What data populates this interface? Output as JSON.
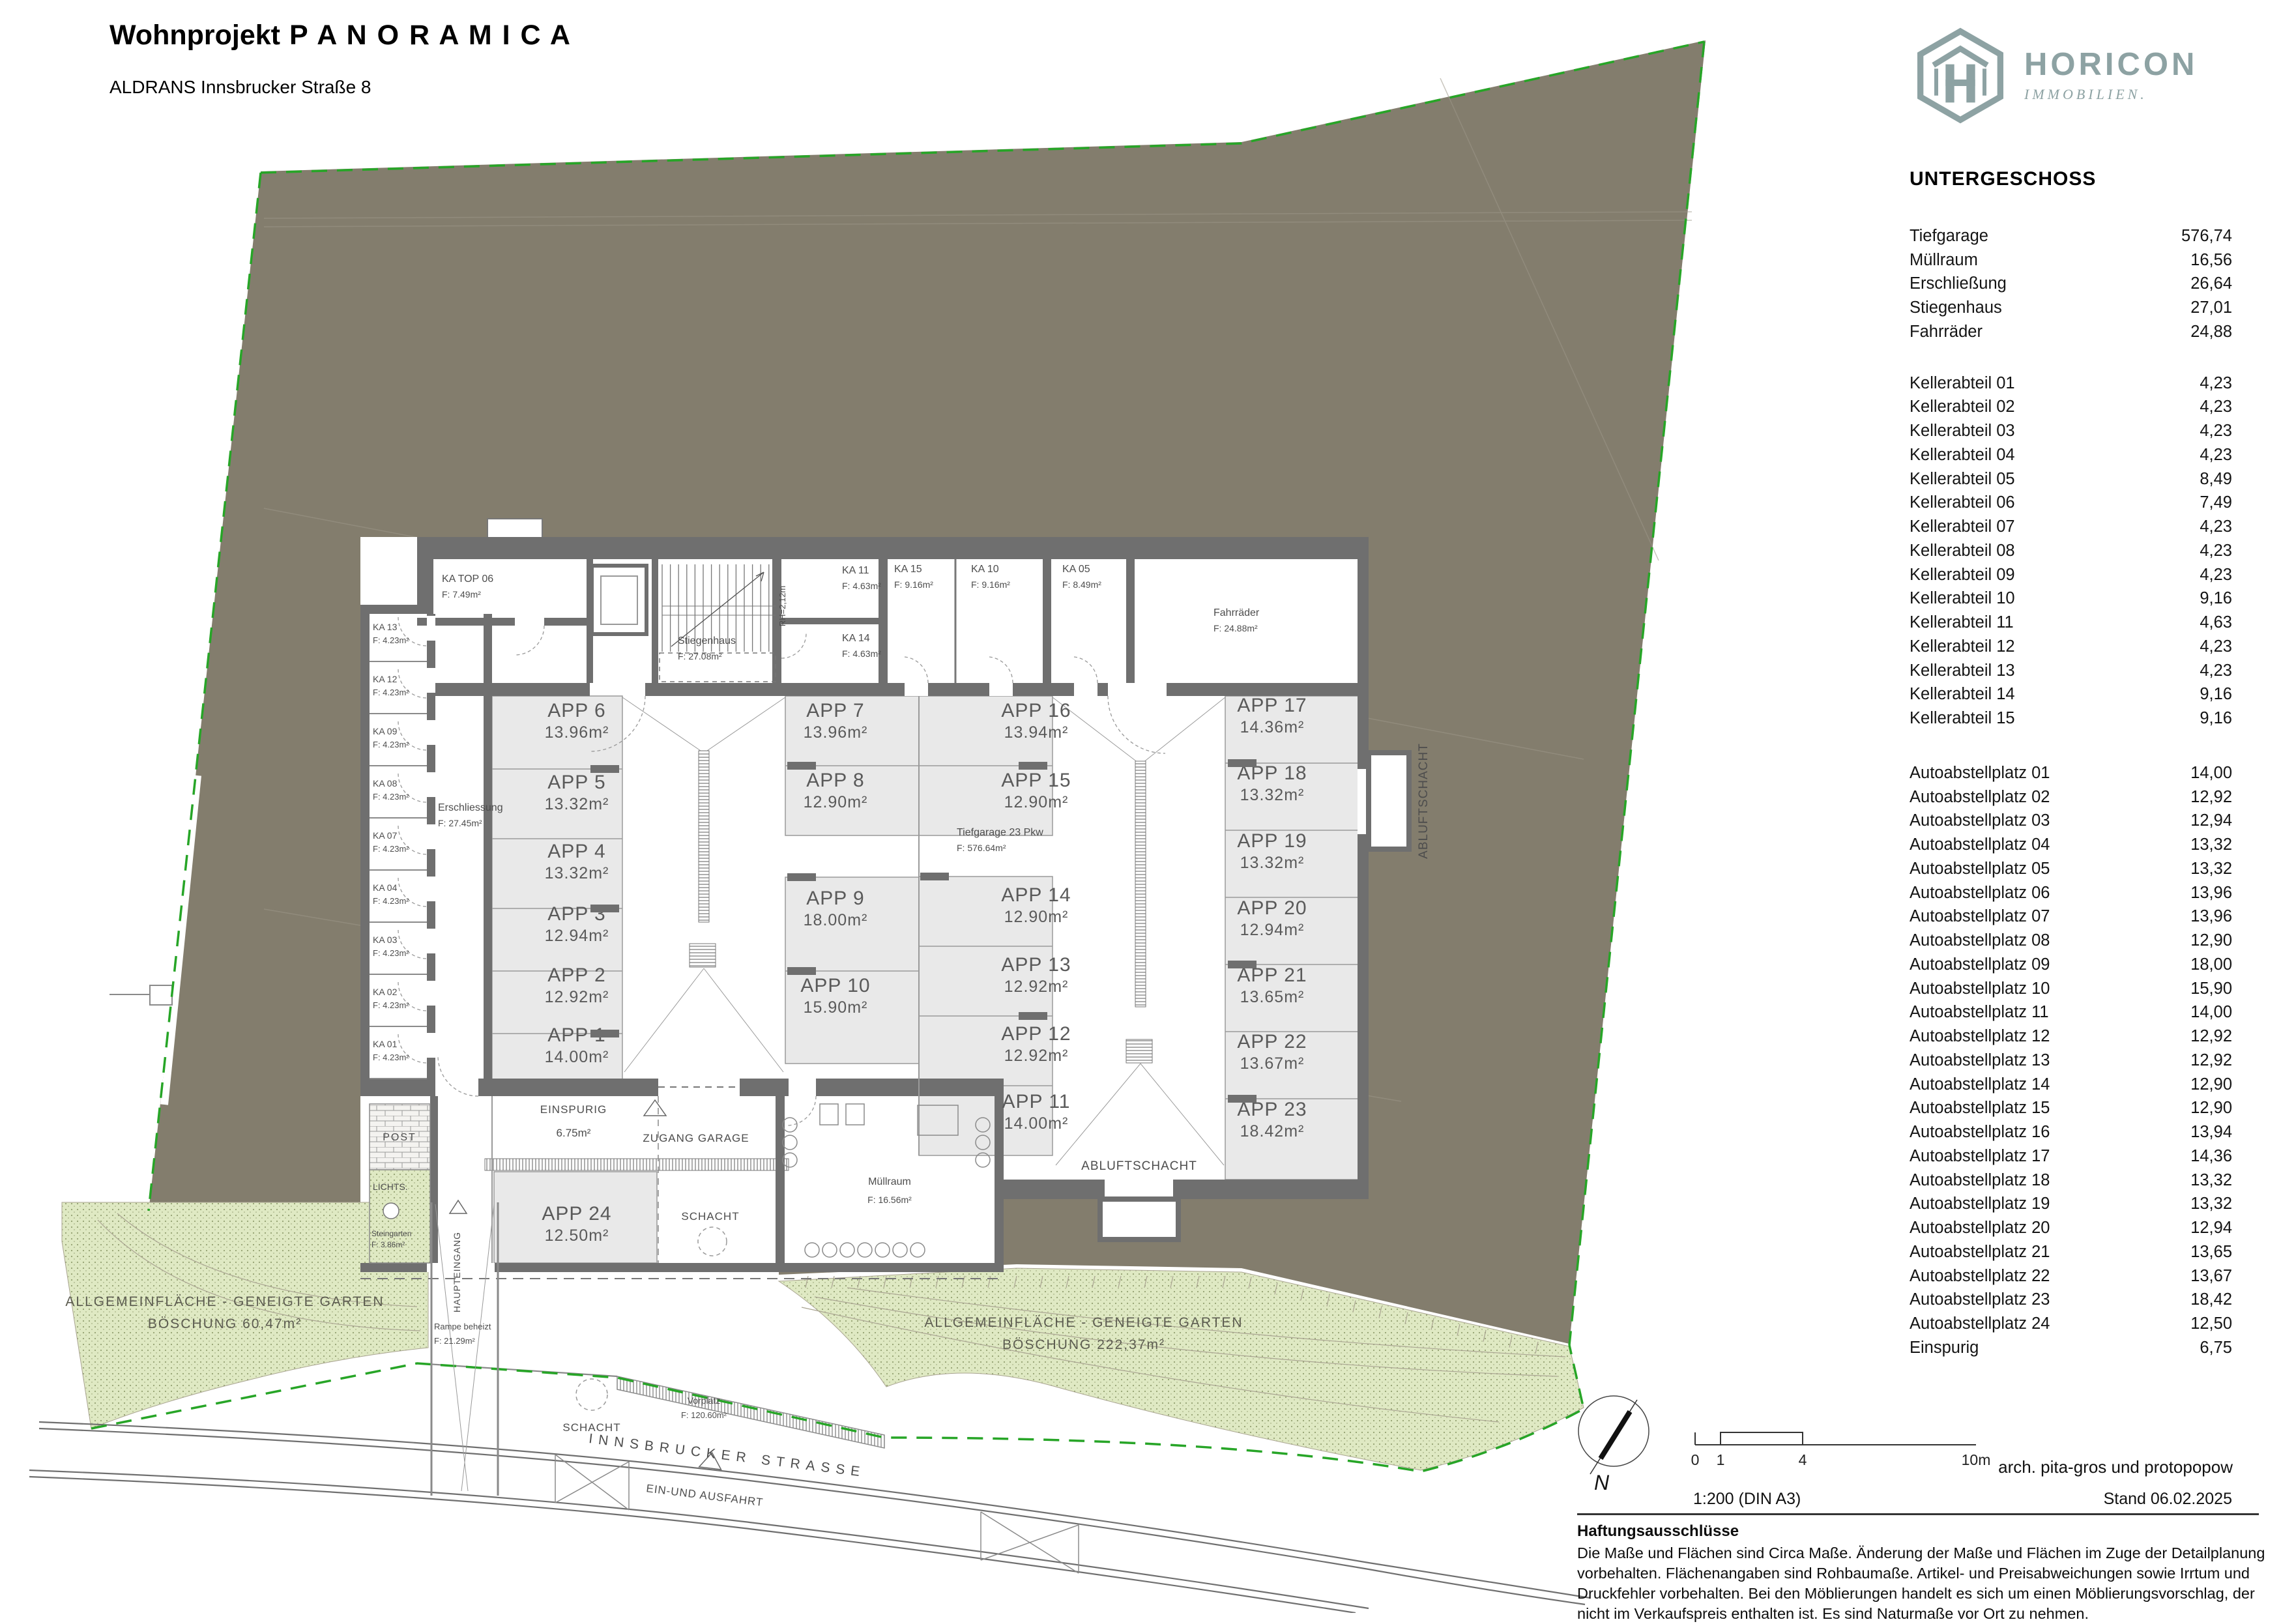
{
  "title": {
    "project": "Wohnprojekt",
    "name": "P A N O R A M I C A",
    "subtitle": "ALDRANS Innsbrucker Straße 8"
  },
  "logo": {
    "brand": "HORICON",
    "tagline": "IMMOBILIEN.",
    "color": "#8da2a3"
  },
  "sheet": {
    "floor_label": "UNTERGESCHOSS",
    "scale": "1:200 (DIN A3)",
    "architect": "arch. pita-gros und protopopow",
    "stand": "Stand 06.02.2025"
  },
  "scalebar": {
    "t0": "0",
    "t1": "1",
    "t4": "4",
    "t10": "10m",
    "north": "N"
  },
  "areas_table": {
    "general": [
      {
        "label": "Tiefgarage",
        "value": "576,74"
      },
      {
        "label": "Müllraum",
        "value": "16,56"
      },
      {
        "label": "Erschließung",
        "value": "26,64"
      },
      {
        "label": "Stiegenhaus",
        "value": "27,01"
      },
      {
        "label": "Fahrräder",
        "value": "24,88"
      }
    ],
    "keller": [
      {
        "label": "Kellerabteil 01",
        "value": "4,23"
      },
      {
        "label": "Kellerabteil 02",
        "value": "4,23"
      },
      {
        "label": "Kellerabteil 03",
        "value": "4,23"
      },
      {
        "label": "Kellerabteil 04",
        "value": "4,23"
      },
      {
        "label": "Kellerabteil 05",
        "value": "8,49"
      },
      {
        "label": "Kellerabteil 06",
        "value": "7,49"
      },
      {
        "label": "Kellerabteil 07",
        "value": "4,23"
      },
      {
        "label": "Kellerabteil 08",
        "value": "4,23"
      },
      {
        "label": "Kellerabteil 09",
        "value": "4,23"
      },
      {
        "label": "Kellerabteil 10",
        "value": "9,16"
      },
      {
        "label": "Kellerabteil 11",
        "value": "4,63"
      },
      {
        "label": "Kellerabteil 12",
        "value": "4,23"
      },
      {
        "label": "Kellerabteil 13",
        "value": "4,23"
      },
      {
        "label": "Kellerabteil 14",
        "value": "9,16"
      },
      {
        "label": "Kellerabteil 15",
        "value": "9,16"
      }
    ],
    "auto": [
      {
        "label": "Autoabstellplatz 01",
        "value": "14,00"
      },
      {
        "label": "Autoabstellplatz 02",
        "value": "12,92"
      },
      {
        "label": "Autoabstellplatz 03",
        "value": "12,94"
      },
      {
        "label": "Autoabstellplatz 04",
        "value": "13,32"
      },
      {
        "label": "Autoabstellplatz 05",
        "value": "13,32"
      },
      {
        "label": "Autoabstellplatz 06",
        "value": "13,96"
      },
      {
        "label": "Autoabstellplatz 07",
        "value": "13,96"
      },
      {
        "label": "Autoabstellplatz 08",
        "value": "12,90"
      },
      {
        "label": "Autoabstellplatz 09",
        "value": "18,00"
      },
      {
        "label": "Autoabstellplatz 10",
        "value": "15,90"
      },
      {
        "label": "Autoabstellplatz 11",
        "value": "14,00"
      },
      {
        "label": "Autoabstellplatz 12",
        "value": "12,92"
      },
      {
        "label": "Autoabstellplatz 13",
        "value": "12,92"
      },
      {
        "label": "Autoabstellplatz 14",
        "value": "12,90"
      },
      {
        "label": "Autoabstellplatz 15",
        "value": "12,90"
      },
      {
        "label": "Autoabstellplatz 16",
        "value": "13,94"
      },
      {
        "label": "Autoabstellplatz 17",
        "value": "14,36"
      },
      {
        "label": "Autoabstellplatz 18",
        "value": "13,32"
      },
      {
        "label": "Autoabstellplatz 19",
        "value": "13,32"
      },
      {
        "label": "Autoabstellplatz 20",
        "value": "12,94"
      },
      {
        "label": "Autoabstellplatz 21",
        "value": "13,65"
      },
      {
        "label": "Autoabstellplatz 22",
        "value": "13,67"
      },
      {
        "label": "Autoabstellplatz 23",
        "value": "18,42"
      },
      {
        "label": "Autoabstellplatz 24",
        "value": "12,50"
      },
      {
        "label": "Einspurig",
        "value": "6,75"
      }
    ]
  },
  "disclaimer": {
    "heading": "Haftungsausschlüsse",
    "body": "Die Maße und Flächen sind Circa Maße. Änderung der Maße und Flächen im Zuge der Detailplanung vorbehalten. Flächenangaben sind Rohbaumaße. Artikel- und Preisabweichungen sowie Irrtum und Druckfehler vorbehalten. Bei den Möblierungen handelt es sich um einen Möblierungsvorschlag, der nicht im Verkaufspreis enthalten ist. Es sind Naturmaße vor Ort zu nehmen."
  },
  "plan": {
    "stalls": [
      {
        "id": "APP 1",
        "area": "14.00m²"
      },
      {
        "id": "APP 2",
        "area": "12.92m²"
      },
      {
        "id": "APP 3",
        "area": "12.94m²"
      },
      {
        "id": "APP 4",
        "area": "13.32m²"
      },
      {
        "id": "APP 5",
        "area": "13.32m²"
      },
      {
        "id": "APP 6",
        "area": "13.96m²"
      },
      {
        "id": "APP 7",
        "area": "13.96m²"
      },
      {
        "id": "APP 8",
        "area": "12.90m²"
      },
      {
        "id": "APP 9",
        "area": "18.00m²"
      },
      {
        "id": "APP 10",
        "area": "15.90m²"
      },
      {
        "id": "APP 11",
        "area": "14.00m²"
      },
      {
        "id": "APP 12",
        "area": "12.92m²"
      },
      {
        "id": "APP 13",
        "area": "12.92m²"
      },
      {
        "id": "APP 14",
        "area": "12.90m²"
      },
      {
        "id": "APP 15",
        "area": "12.90m²"
      },
      {
        "id": "APP 16",
        "area": "13.94m²"
      },
      {
        "id": "APP 17",
        "area": "14.36m²"
      },
      {
        "id": "APP 18",
        "area": "13.32m²"
      },
      {
        "id": "APP 19",
        "area": "13.32m²"
      },
      {
        "id": "APP 20",
        "area": "12.94m²"
      },
      {
        "id": "APP 21",
        "area": "13.65m²"
      },
      {
        "id": "APP 22",
        "area": "13.67m²"
      },
      {
        "id": "APP 23",
        "area": "18.42m²"
      },
      {
        "id": "APP 24",
        "area": "12.50m²"
      }
    ],
    "ka_rooms": [
      {
        "id": "KA 13",
        "area": "F: 4.23m²"
      },
      {
        "id": "KA 12",
        "area": "F: 4.23m²"
      },
      {
        "id": "KA 09",
        "area": "F: 4.23m²"
      },
      {
        "id": "KA 08",
        "area": "F: 4.23m²"
      },
      {
        "id": "KA 07",
        "area": "F: 4.23m²"
      },
      {
        "id": "KA 04",
        "area": "F: 4.23m²"
      },
      {
        "id": "KA 03",
        "area": "F: 4.23m²"
      },
      {
        "id": "KA 02",
        "area": "F: 4.23m²"
      },
      {
        "id": "KA 01",
        "area": "F: 4.23m²"
      }
    ],
    "top_rooms": [
      {
        "id": "KA TOP 06",
        "area": "F: 7.49m²"
      },
      {
        "id": "Stiegenhaus",
        "area": "F: 27.08m²"
      },
      {
        "id": "KA 11",
        "area": "F: 4.63m²"
      },
      {
        "id": "KA 14",
        "area": "F: 4.63m²"
      },
      {
        "id": "KA 15",
        "area": "F: 9.16m²"
      },
      {
        "id": "KA 10",
        "area": "F: 9.16m²"
      },
      {
        "id": "KA 05",
        "area": "F: 8.49m²"
      },
      {
        "id": "Fahrräder",
        "area": "F: 24.88m²"
      }
    ],
    "labels": {
      "einspurig": "EINSPURIG",
      "einspurig_area": "6.75m²",
      "zugang": "ZUGANG GARAGE",
      "schacht": "SCHACHT",
      "muellraum": "Müllraum",
      "muellraum_area": "F: 16.56m²",
      "erschliessung": "Erschliessung",
      "erschliessung_area": "F: 27.45m²",
      "tiefgarage": "Tiefgarage 23 Pkw",
      "tiefgarage_area": "F: 576.64m²",
      "abluftschacht": "ABLUFTSCHACHT",
      "rh": "RH=2,12m",
      "post": "POST",
      "lichts": "LICHTS.",
      "steingarten": "Steingarten",
      "steingarten_area": "F: 3.86m²",
      "haupteingang": "HAUPTEINGANG",
      "rampe": "Rampe beheizt",
      "rampe_area": "F: 21.29m²",
      "vorplatz": "Vorplatz",
      "vorplatz_area": "F: 120.60m²",
      "garden_line1": "ALLGEMEINFLÄCHE - GENEIGTE GARTEN",
      "garden_left_line2": "BÖSCHUNG 60,47m²",
      "garden_right_line2": "BÖSCHUNG 222,37m²",
      "einausfahrt": "EIN-UND AUSFAHRT",
      "strasse": "INNSBRUCKER STRASSE"
    },
    "colors": {
      "site": "#837d6d",
      "garden": "#dfe9c3",
      "boundary_green": "#27a527",
      "wall": "#6f6f6f",
      "stall": "#e9e9e9"
    }
  }
}
